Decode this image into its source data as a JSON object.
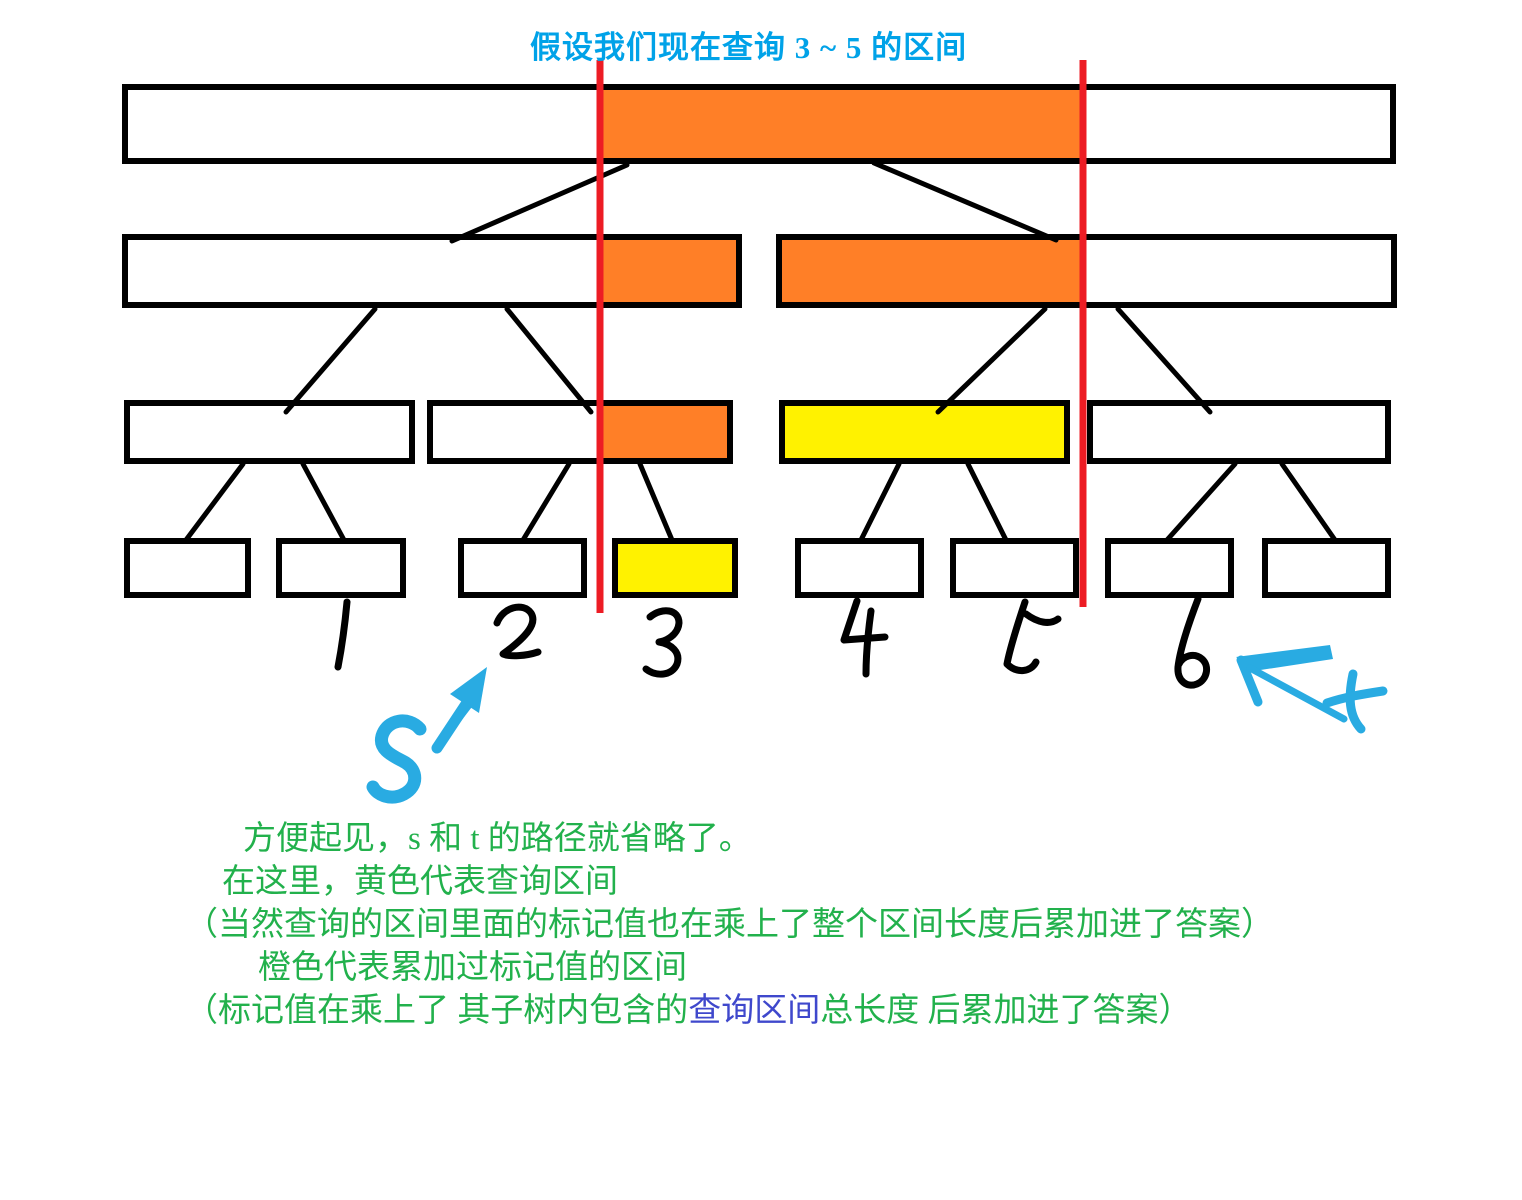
{
  "title": {
    "text": "假设我们现在查询 3 ~ 5 的区间"
  },
  "query": {
    "range_start": "3",
    "range_end": "5"
  },
  "colors": {
    "title_blue": "#00A2E8",
    "sketch_blue": "#29ABE2",
    "orange": "#FF7F27",
    "yellow": "#FFF200",
    "red": "#ED1C24",
    "green": "#22B14C",
    "indigo": "#3F48CC",
    "ink": "#000000",
    "node_fill": "#FFFFFF"
  },
  "notes": {
    "line1": "方便起见，s 和 t 的路径就省略了。",
    "line2": "在这里，黄色代表查询区间",
    "line3": "（当然查询的区间里面的标记值也在乘上了整个区间长度后累加进了答案）",
    "line4": "橙色代表累加过标记值的区间",
    "line5_prefix": "（标记值在乘上了 其子树内包含的",
    "line5_highlight": "查询区间",
    "line5_suffix": "总长度 后累加进了答案）"
  },
  "sketch": {
    "s_label": "s",
    "t_label": "t",
    "s_glyph": "M420,729 C409,716 387,719 382,736 C378,751 396,757 406,763 C417,770 419,786 404,794 C391,801 377,795 373,787",
    "s_arrow_shaft": "M437,748 L474,692",
    "s_arrow_inner": "M445,738 L471,704",
    "s_arrow_head_points": "487,667 450,694 479,713",
    "t_arrow_shaft": "M1250,668 L1344,719",
    "t_arrow_barb_points": "1236,657 1330,645 1333,659 1254,671",
    "t_arrow_barb2": "M1241,660 L1258,702",
    "t_glyph_vertical": "M1353,674 C1348,698 1349,716 1361,729",
    "t_glyph_cross": "M1327,703 C1345,697 1363,694 1383,691"
  },
  "diagram": {
    "canvas": {
      "w": 1522,
      "h": 1200
    },
    "nodes": [
      {
        "id": "root",
        "level": 1,
        "x": 125,
        "y": 87,
        "w": 1268,
        "h": 74,
        "segments": [
          {
            "x": 600,
            "w": 482,
            "fill": "orange"
          }
        ]
      },
      {
        "id": "n2-left",
        "level": 2,
        "x": 125,
        "y": 237,
        "w": 614,
        "h": 68,
        "segments": [
          {
            "x": 600,
            "w": 139,
            "fill": "orange"
          }
        ]
      },
      {
        "id": "n2-right",
        "level": 2,
        "x": 779,
        "y": 237,
        "w": 615,
        "h": 68,
        "segments": [
          {
            "x": 779,
            "w": 303,
            "fill": "orange"
          }
        ]
      },
      {
        "id": "n3-a",
        "level": 3,
        "x": 127,
        "y": 403,
        "w": 285,
        "h": 58,
        "segments": []
      },
      {
        "id": "n3-b",
        "level": 3,
        "x": 430,
        "y": 403,
        "w": 300,
        "h": 58,
        "segments": [
          {
            "x": 601,
            "w": 129,
            "fill": "orange"
          }
        ]
      },
      {
        "id": "n3-c",
        "level": 3,
        "x": 782,
        "y": 403,
        "w": 285,
        "h": 58,
        "segments": [
          {
            "x": 782,
            "w": 285,
            "fill": "yellow"
          }
        ]
      },
      {
        "id": "n3-d",
        "level": 3,
        "x": 1090,
        "y": 403,
        "w": 298,
        "h": 58,
        "segments": []
      },
      {
        "id": "leaf-0",
        "level": 4,
        "x": 127,
        "y": 541,
        "w": 121,
        "h": 54,
        "segments": []
      },
      {
        "id": "leaf-1",
        "level": 4,
        "x": 279,
        "y": 541,
        "w": 124,
        "h": 54,
        "segments": []
      },
      {
        "id": "leaf-2",
        "level": 4,
        "x": 461,
        "y": 541,
        "w": 123,
        "h": 54,
        "segments": []
      },
      {
        "id": "leaf-3",
        "level": 4,
        "x": 615,
        "y": 541,
        "w": 120,
        "h": 54,
        "segments": [
          {
            "x": 615,
            "w": 120,
            "fill": "yellow"
          }
        ]
      },
      {
        "id": "leaf-4",
        "level": 4,
        "x": 798,
        "y": 541,
        "w": 123,
        "h": 54,
        "segments": []
      },
      {
        "id": "leaf-5",
        "level": 4,
        "x": 953,
        "y": 541,
        "w": 123,
        "h": 54,
        "segments": []
      },
      {
        "id": "leaf-6",
        "level": 4,
        "x": 1108,
        "y": 541,
        "w": 123,
        "h": 54,
        "segments": []
      },
      {
        "id": "leaf-7",
        "level": 4,
        "x": 1265,
        "y": 541,
        "w": 123,
        "h": 54,
        "segments": []
      }
    ],
    "edges": [
      [
        627,
        165,
        452,
        241
      ],
      [
        874,
        163,
        1056,
        240
      ],
      [
        375,
        309,
        286,
        412
      ],
      [
        507,
        309,
        591,
        412
      ],
      [
        1045,
        309,
        938,
        412
      ],
      [
        1118,
        309,
        1210,
        412
      ],
      [
        243,
        464,
        186,
        540
      ],
      [
        303,
        464,
        344,
        540
      ],
      [
        569,
        464,
        523,
        540
      ],
      [
        640,
        464,
        672,
        540
      ],
      [
        899,
        464,
        861,
        540
      ],
      [
        968,
        464,
        1006,
        540
      ],
      [
        1235,
        464,
        1167,
        540
      ],
      [
        1282,
        464,
        1335,
        540
      ]
    ],
    "query_lines": [
      {
        "x": 600,
        "y1": 60,
        "y2": 613
      },
      {
        "x": 1083,
        "y1": 60,
        "y2": 607
      }
    ],
    "leaf_labels": [
      {
        "text": "1",
        "path": "M347,602 C345,624 342,646 338,667"
      },
      {
        "text": "2",
        "path": "M497,623 C503,607 523,602 531,613 C538,624 525,638 503,654 C510,657 526,656 538,652"
      },
      {
        "text": "3",
        "path": "M650,617 C662,607 679,609 679,623 C678,635 666,641 659,642 C671,644 681,652 677,664 C672,676 656,677 646,669"
      },
      {
        "text": "4",
        "path": "M857,601 C852,616 848,628 844,640 L885,637 M871,611 C868,633 866,656 866,674"
      },
      {
        "text": "5",
        "path": "M1025,602 C1017,626 1010,648 1007,664 C1017,674 1031,672 1036,662 M1026,614 C1038,623 1050,625 1058,619"
      },
      {
        "text": "6",
        "path": "M1198,599 C1188,625 1180,650 1178,667 C1177,681 1187,688 1197,684 C1207,680 1210,666 1202,659 C1194,652 1183,656 1179,664"
      }
    ]
  }
}
